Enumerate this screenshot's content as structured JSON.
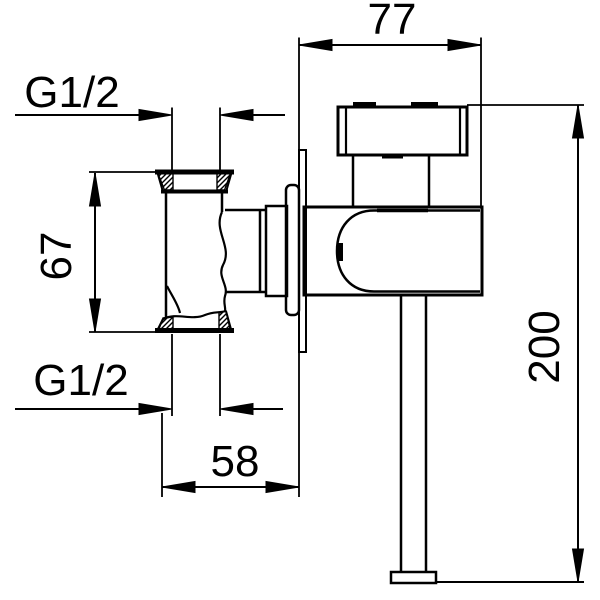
{
  "colors": {
    "background": "#ffffff",
    "line": "#000000"
  },
  "labels": {
    "width_top": "77",
    "thread_top": "G1/2",
    "height_left": "67",
    "thread_bottom": "G1/2",
    "width_bottom": "58",
    "height_right": "200"
  }
}
